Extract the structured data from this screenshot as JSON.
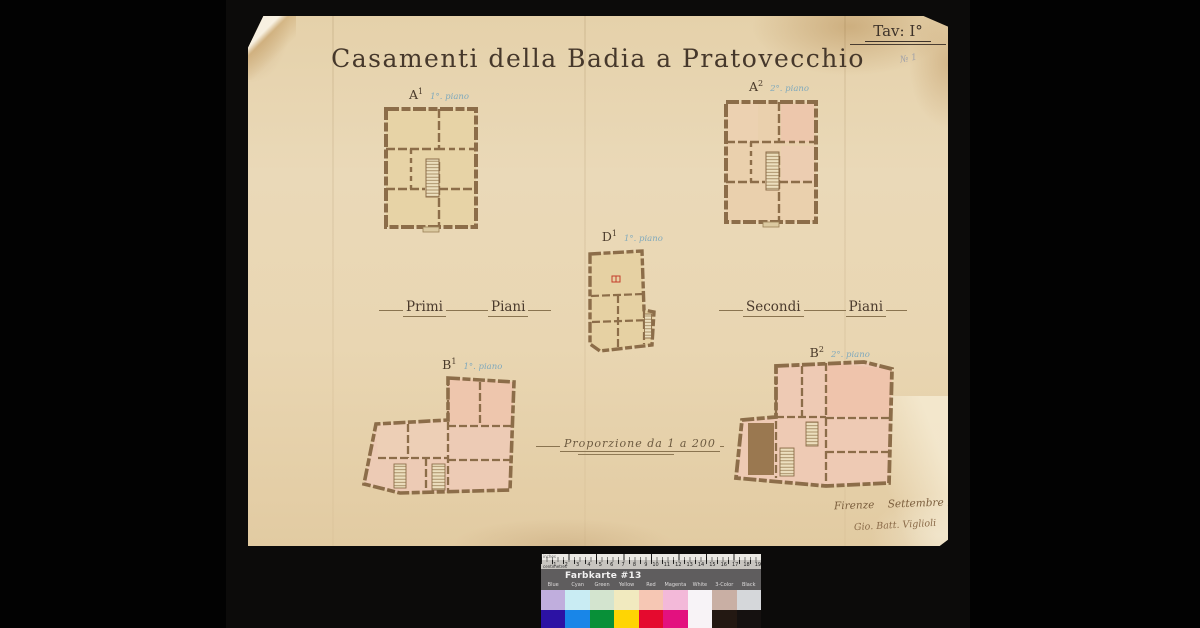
{
  "drawing": {
    "title": "Casamenti della Badia a Pratovecchio",
    "plate_label": "Tav: I°",
    "pencil_note": "№ 1",
    "left_group_label": {
      "word1": "Primi",
      "word2": "Piani"
    },
    "right_group_label": {
      "word1": "Secondi",
      "word2": "Piani"
    },
    "scale_note": "Proporzione da 1 a 200",
    "place_date_note": "Firenze    Settembre 1874",
    "signature": "Gio. Batt. Viglioli",
    "plans": [
      {
        "letter": "A",
        "sup": "1",
        "floor_note": "1°. piano"
      },
      {
        "letter": "A",
        "sup": "2",
        "floor_note": "2°. piano"
      },
      {
        "letter": "D",
        "sup": "1",
        "floor_note": "1°. piano"
      },
      {
        "letter": "B",
        "sup": "1",
        "floor_note": "1°. piano"
      },
      {
        "letter": "B",
        "sup": "2",
        "floor_note": "2°. piano"
      }
    ],
    "ink_color": "#46382b",
    "wall_color": "#8c6d49",
    "wash_tan": "#e7d3a6",
    "wash_pink": "#edcbb5"
  },
  "color_card": {
    "title": "Farbkarte #13",
    "inches_label": "inches",
    "cm_label": "centimetres",
    "cm_numbers": [
      "1",
      "2",
      "3",
      "4",
      "5",
      "6",
      "7",
      "8",
      "9",
      "10",
      "11",
      "12",
      "13",
      "14",
      "15",
      "16",
      "17",
      "18",
      "19"
    ],
    "columns": [
      {
        "label": "Blue",
        "pastel": "#c0aedd",
        "solid": "#2c12a4"
      },
      {
        "label": "Cyan",
        "pastel": "#c9ecf3",
        "solid": "#1986e8"
      },
      {
        "label": "Green",
        "pastel": "#d3e4cf",
        "solid": "#089038"
      },
      {
        "label": "Yellow",
        "pastel": "#f1eabf",
        "solid": "#ffd503"
      },
      {
        "label": "Red",
        "pastel": "#f6c7b4",
        "solid": "#e50a2e"
      },
      {
        "label": "Magenta",
        "pastel": "#f3b9d9",
        "solid": "#e3117f"
      },
      {
        "label": "White",
        "pastel": "#f7f3f7",
        "solid": "#f8f3f6"
      },
      {
        "label": "3-Color",
        "pastel": "#c9afa4",
        "solid": "#231812"
      },
      {
        "label": "Black",
        "pastel": "#d5d7da",
        "solid": "#151110"
      }
    ]
  }
}
